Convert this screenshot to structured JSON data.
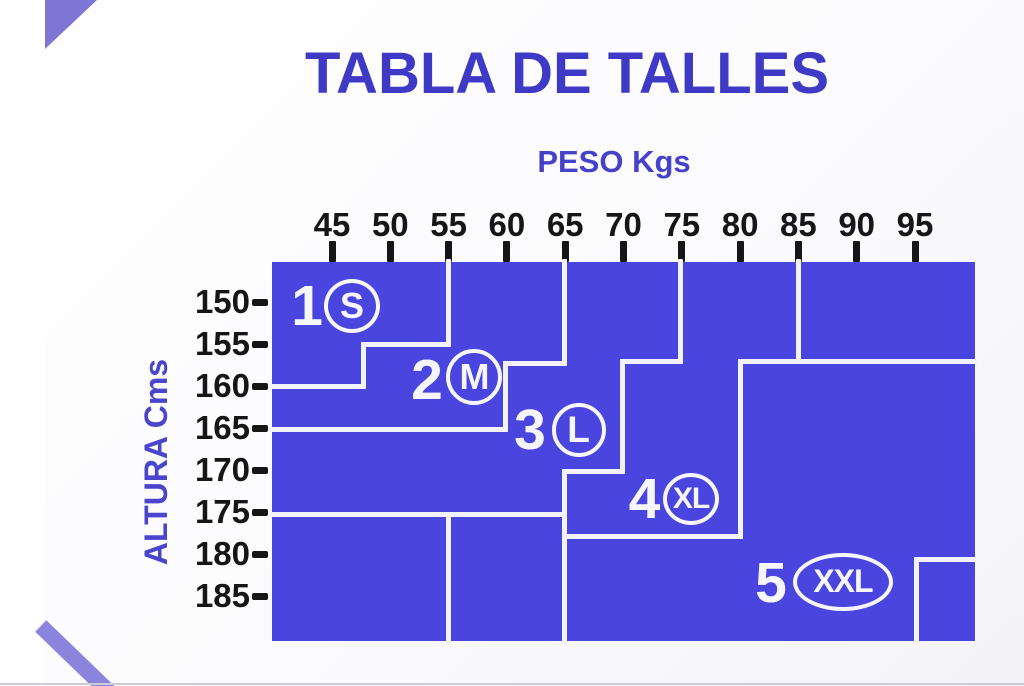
{
  "title": "TABLA DE TALLES",
  "axes": {
    "weight": {
      "label": "PESO Kgs",
      "ticks": [
        45,
        50,
        55,
        60,
        65,
        70,
        75,
        80,
        85,
        90,
        95
      ]
    },
    "height": {
      "label": "ALTURA Cms",
      "ticks": [
        150,
        155,
        160,
        165,
        170,
        175,
        180,
        185
      ]
    }
  },
  "colors": {
    "chart_fill": "#4a45df",
    "boundary_lines": "#f2f2fb",
    "title_text": "#3e3ac6",
    "axis_title_text": "#4641c9",
    "tick_text": "#161616",
    "region_labels": "#f6f6ff",
    "corner_accents": "#8b84dc"
  },
  "chart_data": {
    "type": "area",
    "title": "TABLA DE TALLES",
    "xlabel": "PESO Kgs",
    "ylabel": "ALTURA Cms",
    "x_ticks": [
      45,
      50,
      55,
      60,
      65,
      70,
      75,
      80,
      85,
      90,
      95
    ],
    "y_ticks": [
      150,
      155,
      160,
      165,
      170,
      175,
      180,
      185
    ],
    "x_range": [
      39.8,
      100.1
    ],
    "y_range": [
      145.2,
      190.4
    ],
    "grid": false,
    "legend": "none",
    "regions": [
      {
        "size": "1",
        "label": "S",
        "max_weight_kg": 55,
        "max_height_cm": 160
      },
      {
        "size": "2",
        "label": "M",
        "max_weight_kg": 65,
        "max_height_cm": 165
      },
      {
        "size": "3",
        "label": "L",
        "max_weight_kg": 75,
        "max_height_cm": 170
      },
      {
        "size": "4",
        "label": "XL",
        "max_weight_kg": 85,
        "max_height_cm": 178
      },
      {
        "size": "5",
        "label": "XXL",
        "max_weight_kg": 100,
        "max_height_cm": 190
      }
    ],
    "boundaries": [
      {
        "name": "s-m",
        "points": [
          [
            54.95,
            145.2
          ],
          [
            54.95,
            155.1
          ],
          [
            47.7,
            155.1
          ],
          [
            47.7,
            160.0
          ],
          [
            39.85,
            160.0
          ]
        ]
      },
      {
        "name": "m-l",
        "points": [
          [
            64.9,
            145.2
          ],
          [
            64.9,
            157.3
          ],
          [
            59.9,
            157.3
          ],
          [
            59.9,
            165.2
          ],
          [
            39.85,
            165.2
          ]
        ]
      },
      {
        "name": "l-xl",
        "points": [
          [
            74.85,
            145.2
          ],
          [
            74.85,
            157.1
          ],
          [
            69.9,
            157.1
          ],
          [
            69.9,
            170.2
          ],
          [
            64.9,
            170.2
          ],
          [
            64.9,
            190.4
          ]
        ]
      },
      {
        "name": "xl-xxl",
        "points": [
          [
            85.0,
            145.2
          ],
          [
            85.0,
            157.1
          ],
          [
            80.0,
            157.1
          ],
          [
            80.0,
            177.9
          ],
          [
            64.9,
            177.9
          ]
        ]
      },
      {
        "name": "xxl-top",
        "points": [
          [
            85.0,
            157.1
          ],
          [
            100.1,
            157.1
          ]
        ]
      },
      {
        "name": "low-left-h",
        "points": [
          [
            39.85,
            175.3
          ],
          [
            64.9,
            175.3
          ]
        ]
      },
      {
        "name": "low-left-v",
        "points": [
          [
            55.0,
            175.3
          ],
          [
            55.0,
            190.4
          ]
        ]
      },
      {
        "name": "notch-v",
        "points": [
          [
            95.1,
            180.6
          ],
          [
            95.1,
            190.4
          ]
        ]
      },
      {
        "name": "notch-h",
        "points": [
          [
            95.1,
            180.6
          ],
          [
            100.1,
            180.6
          ]
        ]
      }
    ],
    "annotations": [
      {
        "size": "1",
        "letter": "S",
        "num_at": [
          42.86,
          150.48
        ],
        "mark_at": [
          46.72,
          150.42
        ],
        "rx": 28,
        "ry": 27,
        "letter_font": 36
      },
      {
        "size": "2",
        "letter": "M",
        "num_at": [
          53.15,
          159.29
        ],
        "mark_at": [
          57.22,
          158.93
        ],
        "rx": 28,
        "ry": 28,
        "letter_font": 36
      },
      {
        "size": "3",
        "letter": "L",
        "num_at": [
          61.98,
          165.24
        ],
        "mark_at": [
          66.15,
          165.2
        ],
        "rx": 27,
        "ry": 27,
        "letter_font": 37
      },
      {
        "size": "4",
        "letter": "XL",
        "num_at": [
          71.8,
          173.45
        ],
        "mark_at": [
          75.79,
          173.45
        ],
        "rx": 28,
        "ry": 26,
        "letter_font": 30
      },
      {
        "size": "5",
        "letter": "XXL",
        "num_at": [
          82.65,
          183.45
        ],
        "mark_at": [
          88.82,
          183.33
        ],
        "rx": 50,
        "ry": 29,
        "letter_font": 32
      }
    ]
  }
}
